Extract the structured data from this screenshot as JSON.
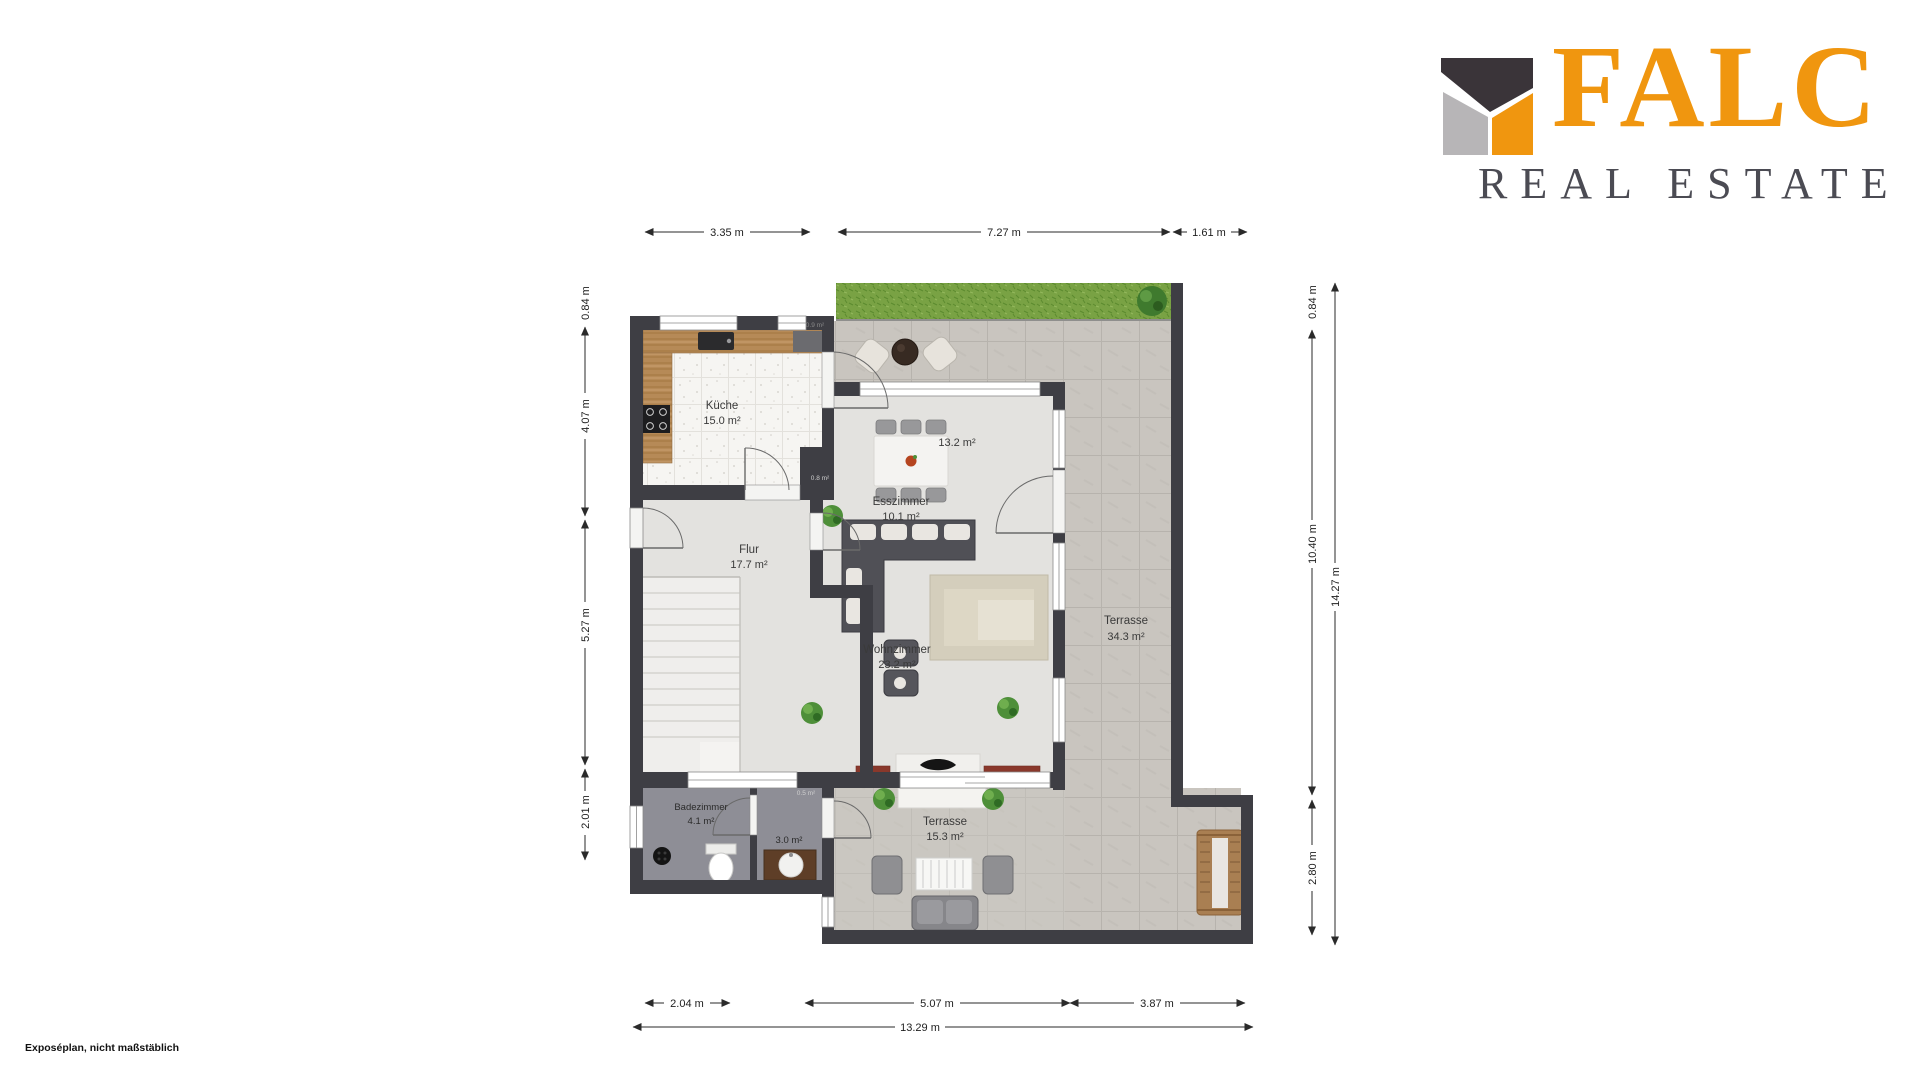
{
  "brand": {
    "name": "FALC",
    "tagline": "REAL ESTATE",
    "colors": {
      "orange": "#F0960F",
      "gray": "#B7B5B7",
      "dark": "#3A3439",
      "text": "#4B4B53"
    }
  },
  "plan": {
    "rooms": [
      {
        "id": "kueche",
        "name": "Küche",
        "area": "15.0 m²"
      },
      {
        "id": "flur",
        "name": "Flur",
        "area": "17.7 m²"
      },
      {
        "id": "esszimmer",
        "name": "Esszimmer",
        "area": "10.1 m²"
      },
      {
        "id": "wohnzimmer",
        "name": "Wohnzimmer",
        "area": "23.2 m²"
      },
      {
        "id": "terrasse-gross",
        "name": "Terrasse",
        "area": "34.3 m²"
      },
      {
        "id": "terrasse-klein",
        "name": "Terrasse",
        "area": "15.3 m²"
      },
      {
        "id": "badezimmer",
        "name": "Badezimmer",
        "area": "4.1 m²"
      }
    ],
    "small_labels": [
      {
        "text": "13.2 m²"
      },
      {
        "text": "3.0 m²"
      },
      {
        "text": "0.9 m²"
      },
      {
        "text": "0.8 m²"
      },
      {
        "text": "0.5 m²"
      }
    ],
    "dimensions": {
      "top": [
        "3.35 m",
        "7.27 m",
        "1.61 m"
      ],
      "left": [
        "0.84 m",
        "4.07 m",
        "5.27 m",
        "2.01 m"
      ],
      "right": [
        "0.84 m",
        "10.40 m",
        "2.80 m",
        "14.27 m"
      ],
      "bottom": [
        "2.04 m",
        "5.07 m",
        "3.87 m",
        "13.29 m"
      ]
    }
  },
  "footer": {
    "disclaimer": "Exposéplan, nicht maßstäblich"
  }
}
